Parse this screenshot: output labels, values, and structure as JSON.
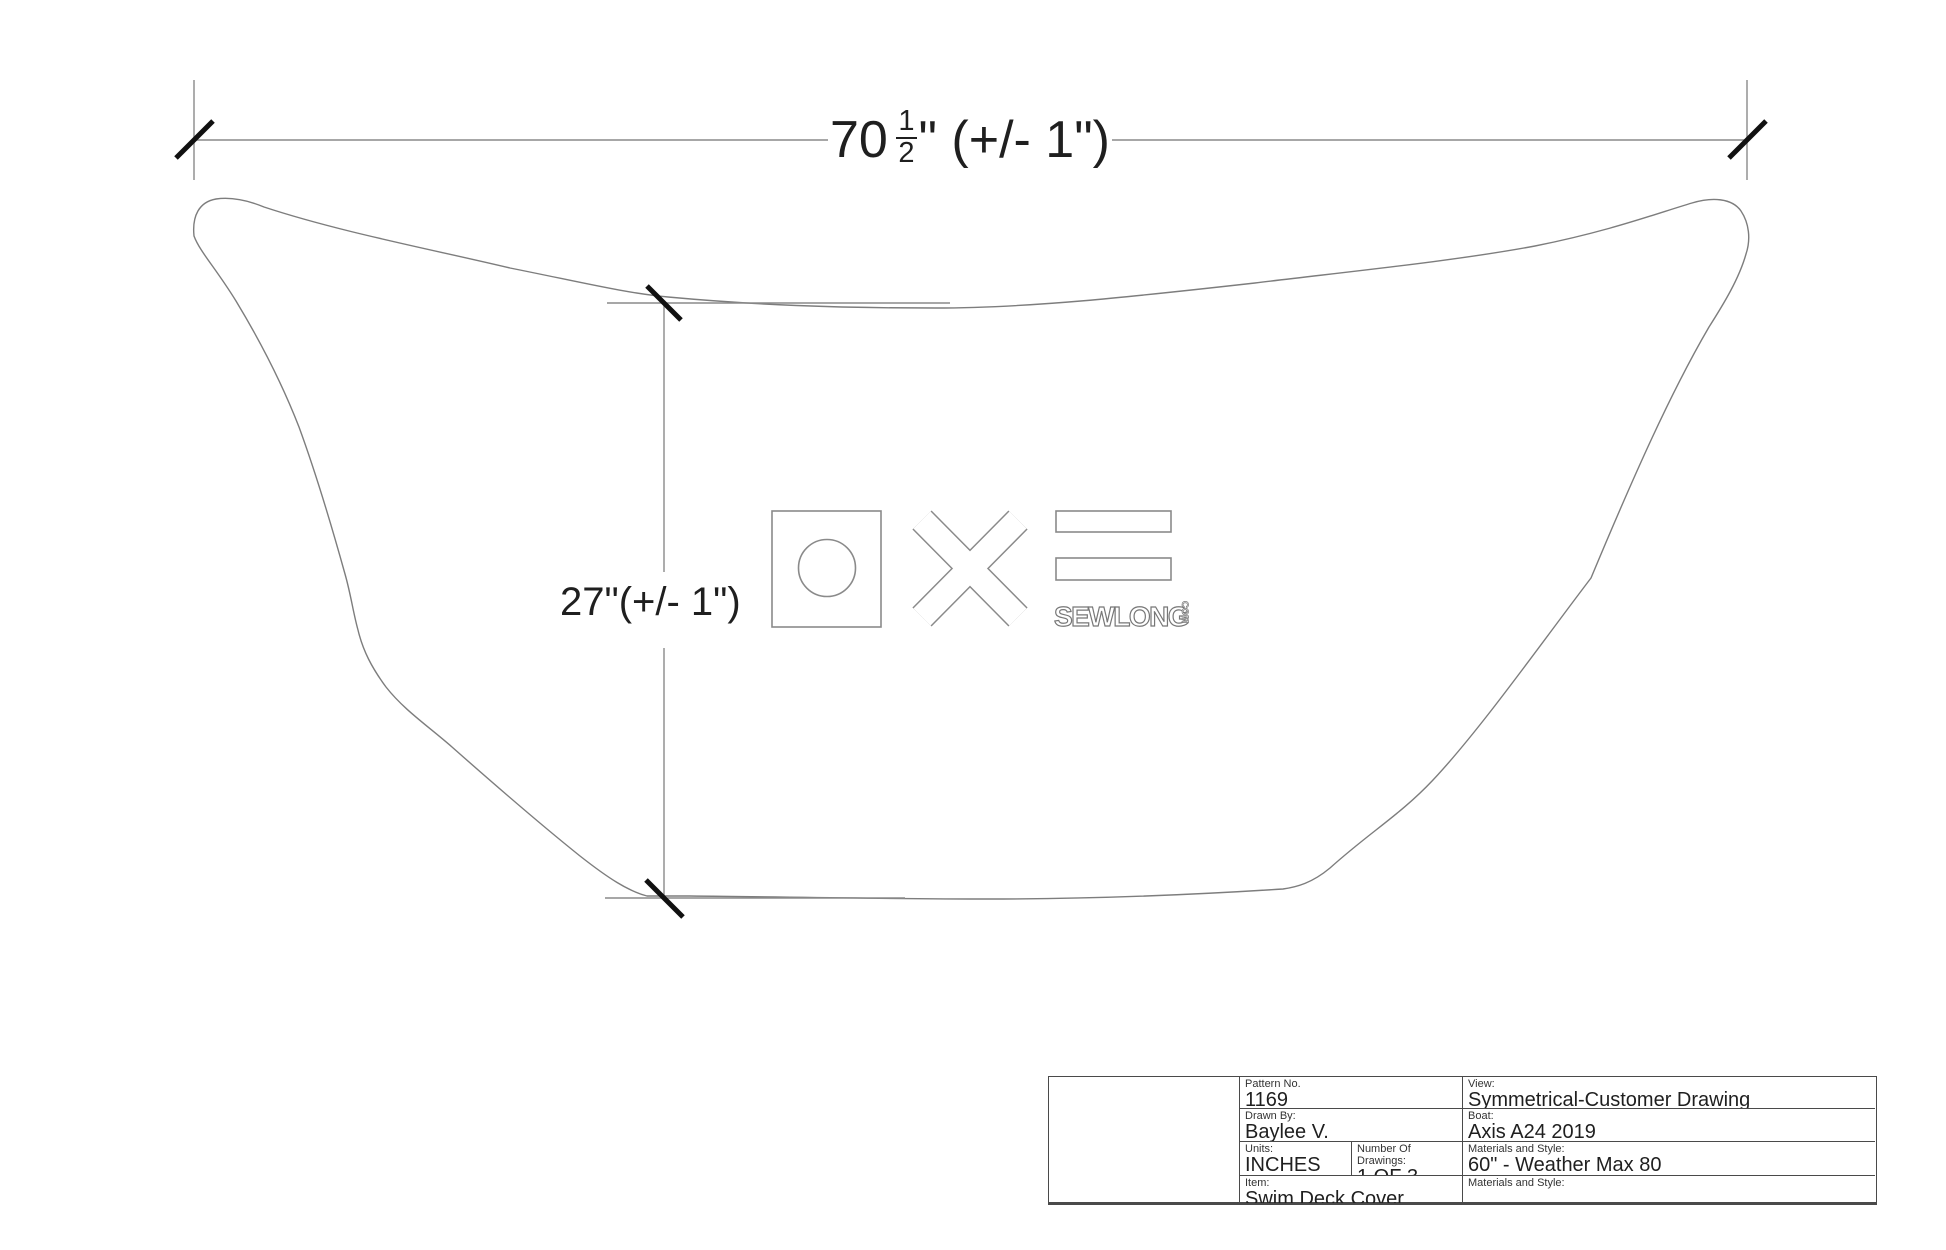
{
  "colors": {
    "background": "#ffffff",
    "outline_line": "#7d7d7d",
    "dimension_line": "#8a8a8a",
    "tick": "#111111",
    "text": "#1f1f1f",
    "table_border": "#4a4a4a"
  },
  "dimensions": {
    "width": {
      "whole": "70",
      "frac_numerator": "1",
      "frac_denominator": "2",
      "suffix": "\" (+/- 1\")"
    },
    "height": {
      "text": "27\"(+/- 1\")"
    }
  },
  "logo": {
    "wordmark": "SEWLONG",
    "wordmark_suffix": "COM"
  },
  "title_block": {
    "pattern": {
      "label": "Pattern No.",
      "value": "1169"
    },
    "drawn_by": {
      "label": "Drawn By:",
      "value": "Baylee V."
    },
    "units": {
      "label": "Units:",
      "value": "INCHES"
    },
    "number_of_drawings": {
      "label": "Number Of Drawings:",
      "value": "1 OF 3"
    },
    "item": {
      "label": "Item:",
      "value": "Swim Deck Cover"
    },
    "view": {
      "label": "View:",
      "value": "Symmetrical-Customer Drawing"
    },
    "boat": {
      "label": "Boat:",
      "value": "Axis A24 2019"
    },
    "materials": {
      "label": "Materials and Style:",
      "value": "60\" - Weather Max 80"
    },
    "materials_2": {
      "label": "Materials and Style:",
      "value": ""
    }
  }
}
